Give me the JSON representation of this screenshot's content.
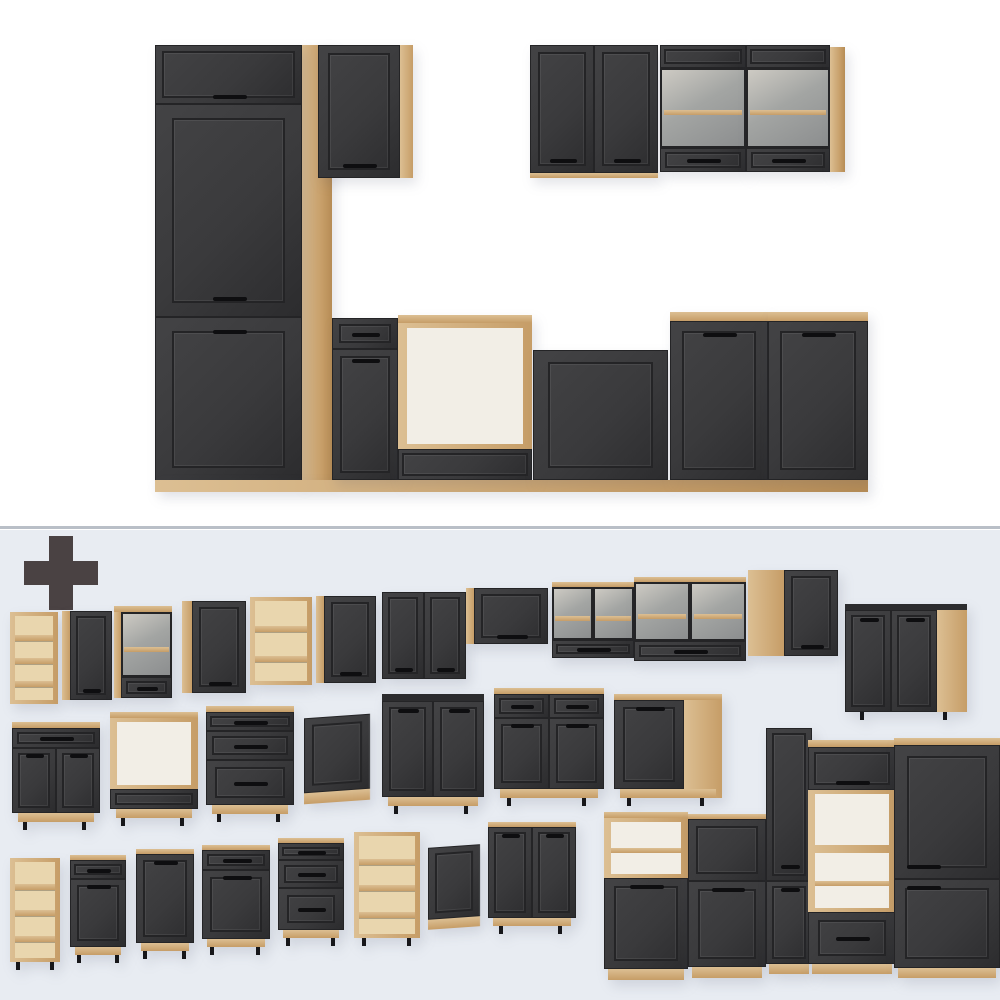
{
  "meta": {
    "description": "Product image of a modular kitchen furniture set: assembled kitchen block on white background (top), plus-sign and all individual cabinet modules on pale blue-gray background (bottom)",
    "text_content": "none - image contains no text"
  },
  "colors": {
    "bg_top": "#ffffff",
    "bg_bottom": "#e8ecf2",
    "divider": "#b9bfc7",
    "plus": "#4a4243",
    "wood_hi": "#dcbf93",
    "wood_lo": "#c69d67",
    "wood_edge": "#b68c55",
    "wood_interior": "#e9d6ae",
    "dark_hi": "#434345",
    "dark_mid": "#3a3a3c",
    "dark_lo": "#2c2c2e",
    "frame": "#242426",
    "handle": "#0e0e10",
    "interior_white": "#f2eee6",
    "glass_hi": "#cdcac3",
    "glass_mid": "#a3a5a3",
    "glass_lo": "#8c8e8f",
    "leg": "#17171a"
  },
  "plus_icon": {
    "x": 24,
    "y": 536,
    "size": 74,
    "thickness": 24
  },
  "divider_y": 526,
  "items": [
    {
      "name": "filler-panel-wood",
      "x": 300,
      "y": 45,
      "w": 32,
      "h": 437,
      "parts": [
        {
          "t": "wood",
          "f": 1
        }
      ]
    },
    {
      "name": "tall-fridge-housing-assembled",
      "x": 155,
      "y": 45,
      "w": 147,
      "h": 437,
      "parts": [
        {
          "t": "door",
          "f": 0.135,
          "handle": "bottom"
        },
        {
          "t": "door",
          "f": 0.487,
          "handle": "bottom"
        },
        {
          "t": "door",
          "f": 0.378,
          "handle": "top"
        }
      ]
    },
    {
      "name": "wall-cabinet-single-assembled",
      "x": 318,
      "y": 45,
      "w": 95,
      "h": 133,
      "side": {
        "pos": "right",
        "w": 13
      },
      "parts": [
        {
          "t": "door",
          "f": 1,
          "handle": "bottom"
        }
      ]
    },
    {
      "name": "wall-cabinet-double-assembled",
      "x": 530,
      "y": 45,
      "w": 128,
      "h": 133,
      "plinth": {
        "h": 5,
        "inset": 0
      },
      "parts": [
        {
          "t": "door",
          "f": 1,
          "cols": 2,
          "handle": "bottom"
        }
      ]
    },
    {
      "name": "wall-glass-cabinet-left-assembled",
      "x": 660,
      "y": 45,
      "w": 86,
      "h": 127,
      "parts": [
        {
          "t": "panel",
          "f": 0.18
        },
        {
          "t": "glass",
          "f": 0.63
        },
        {
          "t": "drawer",
          "f": 0.19,
          "handle": "center"
        }
      ]
    },
    {
      "name": "wall-glass-cabinet-right-assembled",
      "x": 746,
      "y": 45,
      "w": 84,
      "h": 127,
      "parts": [
        {
          "t": "panel",
          "f": 0.18
        },
        {
          "t": "glass",
          "f": 0.63
        },
        {
          "t": "drawer",
          "f": 0.19,
          "handle": "center"
        }
      ]
    },
    {
      "name": "wall-glass-side-panel",
      "x": 830,
      "y": 47,
      "w": 15,
      "h": 125,
      "parts": [
        {
          "t": "wood",
          "f": 1
        }
      ]
    },
    {
      "name": "kitchen-plinth-run",
      "x": 155,
      "y": 480,
      "w": 713,
      "h": 12,
      "parts": [
        {
          "t": "wood",
          "f": 1
        }
      ]
    },
    {
      "name": "base-drawer-door-assembled",
      "x": 332,
      "y": 318,
      "w": 66,
      "h": 162,
      "parts": [
        {
          "t": "drawer",
          "f": 0.19,
          "handle": "center"
        },
        {
          "t": "door",
          "f": 0.81,
          "handle": "top"
        }
      ]
    },
    {
      "name": "oven-housing-assembled",
      "x": 398,
      "y": 315,
      "w": 134,
      "h": 165,
      "topEdge": {
        "h": 8,
        "kind": "wood"
      },
      "parts": [
        {
          "t": "open",
          "f": 0.8,
          "shelves": 0
        },
        {
          "t": "panel",
          "f": 0.2
        }
      ]
    },
    {
      "name": "sink-base-assembled",
      "x": 533,
      "y": 350,
      "w": 135,
      "h": 130,
      "parts": [
        {
          "t": "panel",
          "f": 1
        }
      ]
    },
    {
      "name": "base-door-left-assembled",
      "x": 670,
      "y": 312,
      "w": 98,
      "h": 168,
      "topEdge": {
        "h": 9,
        "kind": "wood"
      },
      "parts": [
        {
          "t": "door",
          "f": 1,
          "handle": "top"
        }
      ]
    },
    {
      "name": "base-door-right-assembled",
      "x": 768,
      "y": 312,
      "w": 100,
      "h": 168,
      "topEdge": {
        "h": 9,
        "kind": "wood"
      },
      "parts": [
        {
          "t": "door",
          "f": 1,
          "handle": "top"
        }
      ]
    },
    {
      "name": "wall-open-shelf-narrow",
      "x": 10,
      "y": 612,
      "w": 48,
      "h": 92,
      "parts": [
        {
          "t": "shelves",
          "f": 1,
          "shelves": 3
        }
      ]
    },
    {
      "name": "wall-cabinet-40",
      "x": 62,
      "y": 611,
      "w": 50,
      "h": 89,
      "side": {
        "pos": "left",
        "w": 8
      },
      "parts": [
        {
          "t": "door",
          "f": 1,
          "handle": "bottom"
        }
      ]
    },
    {
      "name": "wall-glass-cabinet-50",
      "x": 114,
      "y": 606,
      "w": 58,
      "h": 92,
      "side": {
        "pos": "left",
        "w": 7
      },
      "topEdge": {
        "h": 6,
        "kind": "wood"
      },
      "parts": [
        {
          "t": "glass",
          "f": 0.76
        },
        {
          "t": "drawer",
          "f": 0.24,
          "handle": "center"
        }
      ]
    },
    {
      "name": "wall-cabinet-60",
      "x": 182,
      "y": 601,
      "w": 64,
      "h": 92,
      "side": {
        "pos": "left",
        "w": 10
      },
      "parts": [
        {
          "t": "door",
          "f": 1,
          "handle": "bottom"
        }
      ]
    },
    {
      "name": "wall-open-shelf-60",
      "x": 250,
      "y": 597,
      "w": 62,
      "h": 88,
      "parts": [
        {
          "t": "shelves",
          "f": 1,
          "shelves": 2
        }
      ]
    },
    {
      "name": "wall-cabinet-60b",
      "x": 316,
      "y": 596,
      "w": 60,
      "h": 87,
      "side": {
        "pos": "left",
        "w": 8
      },
      "parts": [
        {
          "t": "door",
          "f": 1,
          "handle": "bottom"
        }
      ]
    },
    {
      "name": "wall-cabinet-double-80",
      "x": 382,
      "y": 592,
      "w": 84,
      "h": 87,
      "parts": [
        {
          "t": "door",
          "f": 1,
          "cols": 2,
          "handle": "bottom"
        }
      ]
    },
    {
      "name": "wall-flap-cabinet",
      "x": 466,
      "y": 588,
      "w": 82,
      "h": 56,
      "side": {
        "pos": "left",
        "w": 8
      },
      "parts": [
        {
          "t": "door",
          "f": 1,
          "handle": "bottom"
        }
      ]
    },
    {
      "name": "wall-glass-double-80",
      "x": 552,
      "y": 582,
      "w": 82,
      "h": 76,
      "topEdge": {
        "h": 5,
        "kind": "wood"
      },
      "parts": [
        {
          "t": "glass",
          "f": 0.75,
          "cols": 2
        },
        {
          "t": "drawer",
          "f": 0.25,
          "handle": "center"
        }
      ]
    },
    {
      "name": "wall-glass-double-100",
      "x": 634,
      "y": 577,
      "w": 112,
      "h": 84,
      "topEdge": {
        "h": 5,
        "kind": "wood"
      },
      "parts": [
        {
          "t": "glass",
          "f": 0.75,
          "cols": 2
        },
        {
          "t": "drawer",
          "f": 0.25,
          "handle": "center"
        }
      ]
    },
    {
      "name": "corner-wall-cabinet",
      "x": 748,
      "y": 570,
      "w": 90,
      "h": 86,
      "side": {
        "pos": "left",
        "w": 36
      },
      "parts": [
        {
          "t": "door",
          "f": 1,
          "handle": "bottom"
        }
      ]
    },
    {
      "name": "corner-base-cabinet",
      "x": 845,
      "y": 604,
      "w": 122,
      "h": 108,
      "topEdge": {
        "h": 6,
        "kind": "dark"
      },
      "side": {
        "pos": "right",
        "w": 30
      },
      "legs": true,
      "parts": [
        {
          "t": "door",
          "f": 1,
          "cols": 2,
          "handle": "top"
        }
      ]
    },
    {
      "name": "base-drawer-two-door-60",
      "x": 12,
      "y": 722,
      "w": 88,
      "h": 100,
      "topEdge": {
        "h": 6,
        "kind": "wood"
      },
      "plinth": {
        "h": 9,
        "inset": 6
      },
      "legs": true,
      "parts": [
        {
          "t": "drawer",
          "f": 0.23,
          "handle": "center"
        },
        {
          "t": "door",
          "f": 0.77,
          "cols": 2,
          "handle": "top"
        }
      ]
    },
    {
      "name": "oven-base-cabinet",
      "x": 110,
      "y": 712,
      "w": 88,
      "h": 106,
      "topEdge": {
        "h": 6,
        "kind": "wood"
      },
      "plinth": {
        "h": 9,
        "inset": 6
      },
      "legs": true,
      "parts": [
        {
          "t": "open",
          "f": 0.78,
          "shelves": 0
        },
        {
          "t": "drawer",
          "f": 0.22
        }
      ]
    },
    {
      "name": "base-three-drawer-60",
      "x": 206,
      "y": 706,
      "w": 88,
      "h": 108,
      "topEdge": {
        "h": 6,
        "kind": "wood"
      },
      "plinth": {
        "h": 9,
        "inset": 6
      },
      "legs": true,
      "parts": [
        {
          "t": "drawer",
          "f": 0.2,
          "handle": "center"
        },
        {
          "t": "drawer",
          "f": 0.32,
          "handle": "center"
        },
        {
          "t": "drawer",
          "f": 0.48,
          "handle": "center"
        }
      ]
    },
    {
      "name": "dishwasher-front-panel-60",
      "x": 304,
      "y": 716,
      "w": 66,
      "h": 86,
      "skew": -4,
      "plinth": {
        "h": 11,
        "inset": 0
      },
      "parts": [
        {
          "t": "panel",
          "f": 1
        }
      ]
    },
    {
      "name": "sink-base-80",
      "x": 382,
      "y": 694,
      "w": 102,
      "h": 112,
      "topEdge": {
        "h": 7,
        "kind": "dark"
      },
      "plinth": {
        "h": 9,
        "inset": 6
      },
      "legs": true,
      "parts": [
        {
          "t": "door",
          "f": 1,
          "cols": 2,
          "handle": "top"
        }
      ]
    },
    {
      "name": "base-two-drawer-two-door-80",
      "x": 494,
      "y": 688,
      "w": 110,
      "h": 110,
      "topEdge": {
        "h": 6,
        "kind": "wood"
      },
      "plinth": {
        "h": 9,
        "inset": 6
      },
      "legs": true,
      "parts": [
        {
          "t": "drawer",
          "f": 0.25,
          "cols": 2,
          "handle": "center"
        },
        {
          "t": "door",
          "f": 0.75,
          "cols": 2,
          "handle": "top"
        }
      ]
    },
    {
      "name": "base-single-door-80",
      "x": 614,
      "y": 694,
      "w": 108,
      "h": 104,
      "topEdge": {
        "h": 6,
        "kind": "wood"
      },
      "side": {
        "pos": "right",
        "w": 38
      },
      "plinth": {
        "h": 9,
        "inset": 6
      },
      "legs": true,
      "parts": [
        {
          "t": "door",
          "f": 1,
          "handle": "top"
        }
      ]
    },
    {
      "name": "microwave-housing-cabinet",
      "x": 604,
      "y": 812,
      "w": 84,
      "h": 168,
      "topEdge": {
        "h": 6,
        "kind": "wood"
      },
      "plinth": {
        "h": 11,
        "inset": 4
      },
      "parts": [
        {
          "t": "open",
          "f": 0.4,
          "shelves": 1
        },
        {
          "t": "door",
          "f": 0.6,
          "handle": "top"
        }
      ]
    },
    {
      "name": "midi-cabinet-60",
      "x": 688,
      "y": 814,
      "w": 78,
      "h": 164,
      "topEdge": {
        "h": 5,
        "kind": "wood"
      },
      "plinth": {
        "h": 11,
        "inset": 4
      },
      "parts": [
        {
          "t": "panel",
          "f": 0.42
        },
        {
          "t": "door",
          "f": 0.58,
          "handle": "top"
        }
      ]
    },
    {
      "name": "tall-pantry-cabinet",
      "x": 766,
      "y": 728,
      "w": 46,
      "h": 246,
      "plinth": {
        "h": 10,
        "inset": 3
      },
      "parts": [
        {
          "t": "door",
          "f": 0.65,
          "handle": "bottom"
        },
        {
          "t": "door",
          "f": 0.35,
          "handle": "top"
        }
      ]
    },
    {
      "name": "tall-oven-housing",
      "x": 808,
      "y": 740,
      "w": 88,
      "h": 234,
      "topEdge": {
        "h": 7,
        "kind": "wood"
      },
      "plinth": {
        "h": 10,
        "inset": 4
      },
      "parts": [
        {
          "t": "flap",
          "f": 0.2,
          "handle": "bottom"
        },
        {
          "t": "open",
          "f": 0.27,
          "shelves": 0
        },
        {
          "t": "open",
          "f": 0.29,
          "shelves": 1
        },
        {
          "t": "drawer",
          "f": 0.24,
          "handle": "center"
        }
      ]
    },
    {
      "name": "tall-fridge-housing",
      "x": 894,
      "y": 738,
      "w": 106,
      "h": 240,
      "topEdge": {
        "h": 7,
        "kind": "wood"
      },
      "plinth": {
        "h": 10,
        "inset": 4
      },
      "parts": [
        {
          "t": "door",
          "f": 0.6,
          "handle": "bottom",
          "hx": "left"
        },
        {
          "t": "door",
          "f": 0.4,
          "handle": "top",
          "hx": "left"
        }
      ]
    },
    {
      "name": "base-open-shelf-30",
      "x": 10,
      "y": 858,
      "w": 50,
      "h": 104,
      "legs": true,
      "parts": [
        {
          "t": "shelves",
          "f": 1,
          "shelves": 3
        }
      ]
    },
    {
      "name": "base-drawer-door-30",
      "x": 70,
      "y": 855,
      "w": 56,
      "h": 100,
      "topEdge": {
        "h": 5,
        "kind": "wood"
      },
      "plinth": {
        "h": 8,
        "inset": 5
      },
      "legs": true,
      "parts": [
        {
          "t": "drawer",
          "f": 0.22,
          "handle": "center"
        },
        {
          "t": "door",
          "f": 0.78,
          "handle": "top"
        }
      ]
    },
    {
      "name": "base-single-door-30",
      "x": 136,
      "y": 849,
      "w": 58,
      "h": 102,
      "topEdge": {
        "h": 5,
        "kind": "wood"
      },
      "plinth": {
        "h": 8,
        "inset": 5
      },
      "legs": true,
      "parts": [
        {
          "t": "door",
          "f": 1,
          "handle": "top"
        }
      ]
    },
    {
      "name": "base-drawer-door-40",
      "x": 202,
      "y": 845,
      "w": 68,
      "h": 102,
      "topEdge": {
        "h": 5,
        "kind": "wood"
      },
      "plinth": {
        "h": 8,
        "inset": 5
      },
      "legs": true,
      "parts": [
        {
          "t": "drawer",
          "f": 0.22,
          "handle": "center"
        },
        {
          "t": "door",
          "f": 0.78,
          "handle": "top"
        }
      ]
    },
    {
      "name": "base-three-drawer-40",
      "x": 278,
      "y": 838,
      "w": 66,
      "h": 100,
      "topEdge": {
        "h": 5,
        "kind": "wood"
      },
      "plinth": {
        "h": 8,
        "inset": 5
      },
      "legs": true,
      "parts": [
        {
          "t": "drawer",
          "f": 0.2,
          "handle": "center"
        },
        {
          "t": "drawer",
          "f": 0.32,
          "handle": "center"
        },
        {
          "t": "drawer",
          "f": 0.48,
          "handle": "center"
        }
      ]
    },
    {
      "name": "base-open-shelf-45",
      "x": 354,
      "y": 832,
      "w": 66,
      "h": 106,
      "legs": true,
      "parts": [
        {
          "t": "shelves",
          "f": 1,
          "shelves": 3
        }
      ]
    },
    {
      "name": "dishwasher-front-panel-45",
      "x": 428,
      "y": 846,
      "w": 52,
      "h": 82,
      "skew": -4,
      "plinth": {
        "h": 10,
        "inset": 0
      },
      "parts": [
        {
          "t": "panel",
          "f": 1
        }
      ]
    },
    {
      "name": "base-double-door-60",
      "x": 488,
      "y": 822,
      "w": 88,
      "h": 104,
      "topEdge": {
        "h": 5,
        "kind": "wood"
      },
      "plinth": {
        "h": 8,
        "inset": 5
      },
      "legs": true,
      "parts": [
        {
          "t": "door",
          "f": 1,
          "cols": 2,
          "handle": "top"
        }
      ]
    }
  ]
}
